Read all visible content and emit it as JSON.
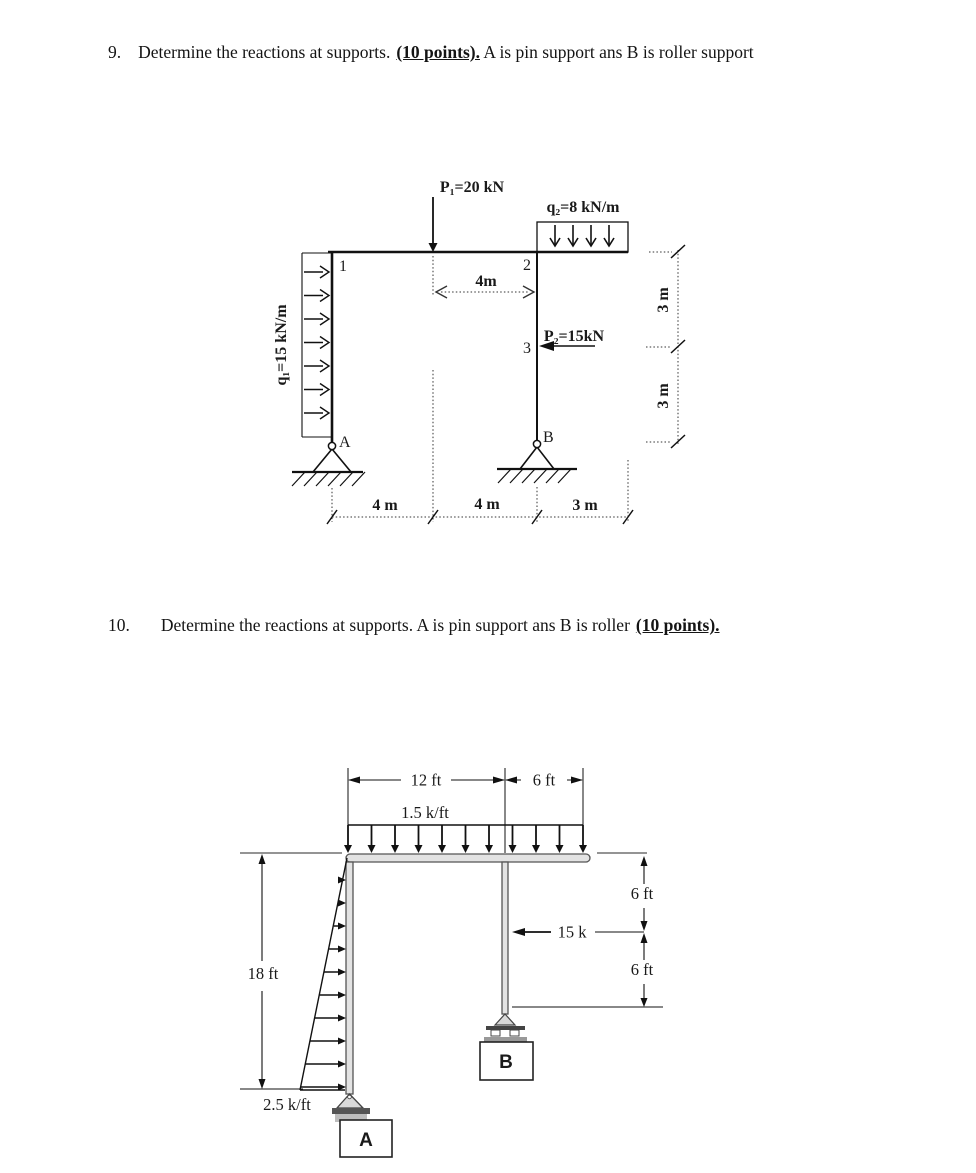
{
  "problem9": {
    "number": "9.",
    "statement": "Determine the reactions at supports.",
    "points": "(10 points).",
    "statement_after": "A is pin support ans B is roller support"
  },
  "problem10": {
    "number": "10.",
    "statement": "Determine the reactions at supports. A is pin support ans B is roller",
    "points": "(10 points)."
  },
  "diagram1": {
    "load_p1": "P₁=20 kN",
    "load_q2": "q₂=8 kN/m",
    "load_q1": "q₁=15 kN/m",
    "load_p2": "P₂=15kN",
    "node_1": "1",
    "node_2": "2",
    "node_3": "3",
    "support_a": "A",
    "support_b": "B",
    "dim_top": "4m",
    "dim_bottom_1": "4 m",
    "dim_bottom_2": "4 m",
    "dim_bottom_3": "3 m",
    "dim_right_upper": "3 m",
    "dim_right_lower": "3 m"
  },
  "diagram2": {
    "dim_span_left": "12 ft",
    "dim_span_right": "6 ft",
    "load_top": "1.5 k/ft",
    "load_left": "2.5 k/ft",
    "dim_height_left": "18 ft",
    "load_mid": "15 k",
    "dim_right_upper": "6 ft",
    "dim_right_lower": "6 ft",
    "support_a": "A",
    "support_b": "B"
  }
}
